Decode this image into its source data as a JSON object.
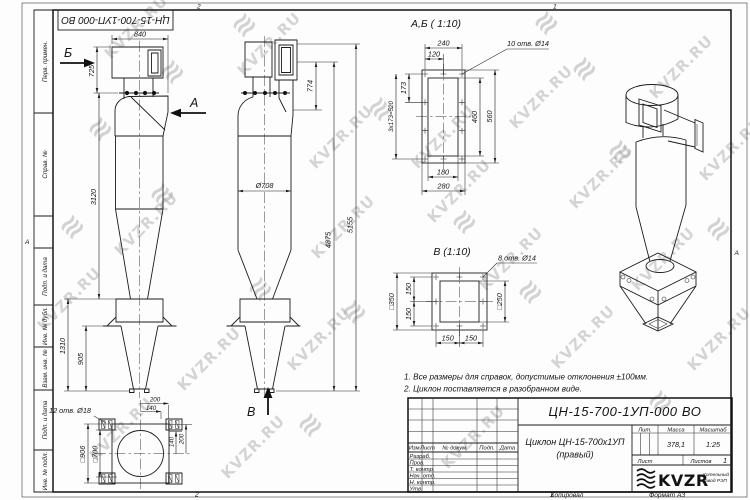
{
  "watermark": {
    "text": "KVZR.RU",
    "icon": "≋"
  },
  "corner_stamp": {
    "designation": "ЦН-15-700-1УП-000 ВО"
  },
  "frame": {
    "zone_top_left": "2",
    "zone_top_right": "1",
    "zone_bottom_left": "2",
    "zone_bottom_right": "1",
    "zone_letter_left": "А",
    "zone_letter_right": "А",
    "stamp_labels": [
      "Перв. примен.",
      "Справ. №",
      "Подп. и дата",
      "Инв. № дубл.",
      "Взам. инв. №",
      "Подп. и дата",
      "Инв. № подл."
    ]
  },
  "views": {
    "front": {
      "label_b": "Б",
      "label_a": "А",
      "d840": "840",
      "d725": "725",
      "d3120": "3120",
      "d1310": "1310",
      "d905": "905"
    },
    "side": {
      "d774": "774",
      "d708": "Ø708",
      "d4875": "4875",
      "d5155": "5155",
      "label_v": "В"
    },
    "section_ab": {
      "title": "А,Б ( 1:10)",
      "holes": "10 отв. Ø14",
      "d240": "240",
      "d120": "120",
      "d173": "173",
      "d520": "3х173=520",
      "d460": "460",
      "d560": "560",
      "d180": "180",
      "d280": "280"
    },
    "section_v": {
      "title": "В (1:10)",
      "holes": "8 отв. Ø14",
      "d350": "□350",
      "d250": "□250",
      "d150_1": "150",
      "d150_2": "150",
      "d150_3": "150",
      "d150_4": "150"
    },
    "bottom": {
      "holes": "12 отв. Ø18",
      "d906": "□906",
      "d700": "□700",
      "d200_top": "200",
      "d140_top": "140",
      "d140_right": "140",
      "d200_right": "200"
    }
  },
  "notes": {
    "line1": "1. Все размеры для справок, допустимые отклонения ±100мм.",
    "line2": "2. Циклон поставляется в разобранном виде."
  },
  "title_block": {
    "designation": "ЦН-15-700-1УП-000 ВО",
    "name_line1": "Циклон ЦН-15-700х1УП",
    "name_line2": "(правый)",
    "col_izm": "Изм.",
    "col_list": "Лист",
    "col_doc": "№ докум.",
    "col_podp": "Подп.",
    "col_data": "Дата",
    "rows": [
      "Разраб.",
      "Пров.",
      "Т. контр.",
      "Нач. отд.",
      "Н. контр.",
      "Утв."
    ],
    "lit": "Лит.",
    "mass": "Масса",
    "scale": "Масштаб",
    "mass_value": "378,1",
    "scale_value": "1:25",
    "sheet": "Лист",
    "sheets": "Листов",
    "sheets_value": "1",
    "logo": "KVZR",
    "org_line1": "Котельный",
    "org_line2": "завод РЭП",
    "copied": "Копировал",
    "format": "Формат А3"
  }
}
